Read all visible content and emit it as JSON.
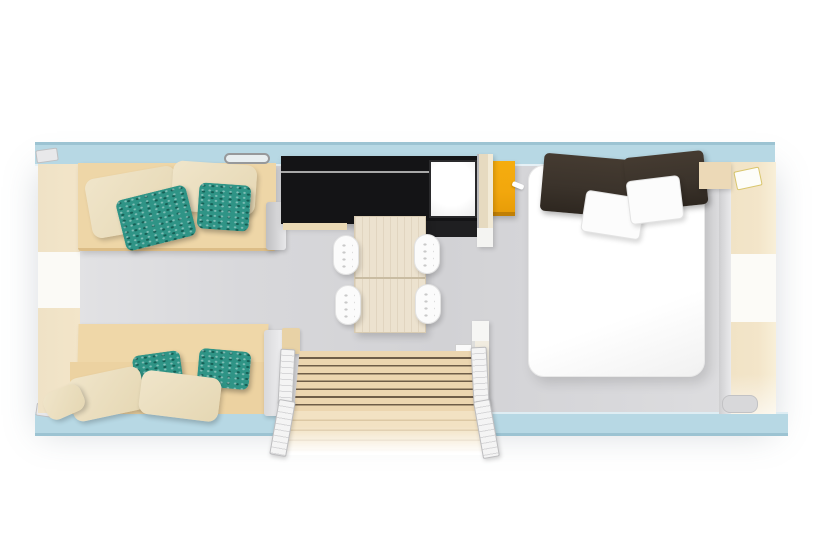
{
  "meta": {
    "type": "floor-plan-render",
    "subject": "mobile-home holiday bungalow top-down 3D floor plan",
    "canvas": {
      "width": 820,
      "height": 560
    },
    "visible_text": []
  },
  "palette": {
    "wall": "#b7d8e4",
    "wallEdge": "#9cc3d2",
    "floor": "#d8d8db",
    "floorLight": "#e4e4e6",
    "sofa": "#eed6a7",
    "sofaEdge": "#dcbd87",
    "pillowBeige": "#f0e5ca",
    "pillowTeal": "#2f9486",
    "pillowTealDark": "#155f55",
    "kitchenDark": "#141416",
    "kitchenLine": "#c2c2c2",
    "applianceWhite": "#f7f7f7",
    "cabinetYellow": "#f2a70d",
    "woodTable": "#ece2cf",
    "woodGrain": "#c9bca2",
    "deckWood": "#ecd6b0",
    "deckGap": "#6e5d48",
    "deckLower": "#f2e2c3",
    "duvet": "#ffffff",
    "pillowDark": "#3b332b",
    "panelBeige": "#f3e5c9",
    "trimGray": "#cfcfd1",
    "railWhite": "#f4f4f4",
    "partition": "#e6dac0",
    "windowDark": "#3c3c3e"
  },
  "rooms": {
    "living_area": {
      "position": "left",
      "items": [
        {
          "name": "sofa-top",
          "color_key": "sofa",
          "pillows": {
            "beige": 2,
            "teal": 2
          }
        },
        {
          "name": "sofa-bottom",
          "color_key": "sofa",
          "pillows": {
            "beige": 3,
            "teal": 2
          }
        },
        {
          "name": "side-bench-left",
          "color_key": "panelBeige"
        },
        {
          "name": "window-top",
          "count": 1
        },
        {
          "name": "window-bottom",
          "count": 1
        }
      ]
    },
    "kitchen_dining": {
      "position": "center",
      "items": [
        {
          "name": "kitchen-counter",
          "color_key": "kitchenDark"
        },
        {
          "name": "appliance-white",
          "color_key": "applianceWhite"
        },
        {
          "name": "cabinet-yellow",
          "color_key": "cabinetYellow"
        },
        {
          "name": "dining-table",
          "color_key": "woodTable",
          "segments": 2
        },
        {
          "name": "chair-white",
          "count": 4
        }
      ]
    },
    "bedroom": {
      "position": "right",
      "items": [
        {
          "name": "double-bed",
          "color_key": "duvet",
          "pillows": {
            "dark": 2,
            "white": 2
          }
        },
        {
          "name": "bedside-shelf",
          "color_key": "panelBeige"
        },
        {
          "name": "wardrobe-right",
          "color_key": "panelBeige"
        }
      ]
    },
    "entrance": {
      "position": "bottom-center",
      "items": [
        {
          "name": "wood-deck-steps",
          "color_key": "deckWood",
          "board_rows": 7
        },
        {
          "name": "railing-left",
          "count": 2
        },
        {
          "name": "railing-right",
          "count": 2
        },
        {
          "name": "door-leaf",
          "count": 1
        },
        {
          "name": "partition-wall",
          "segments": 2
        }
      ]
    }
  }
}
